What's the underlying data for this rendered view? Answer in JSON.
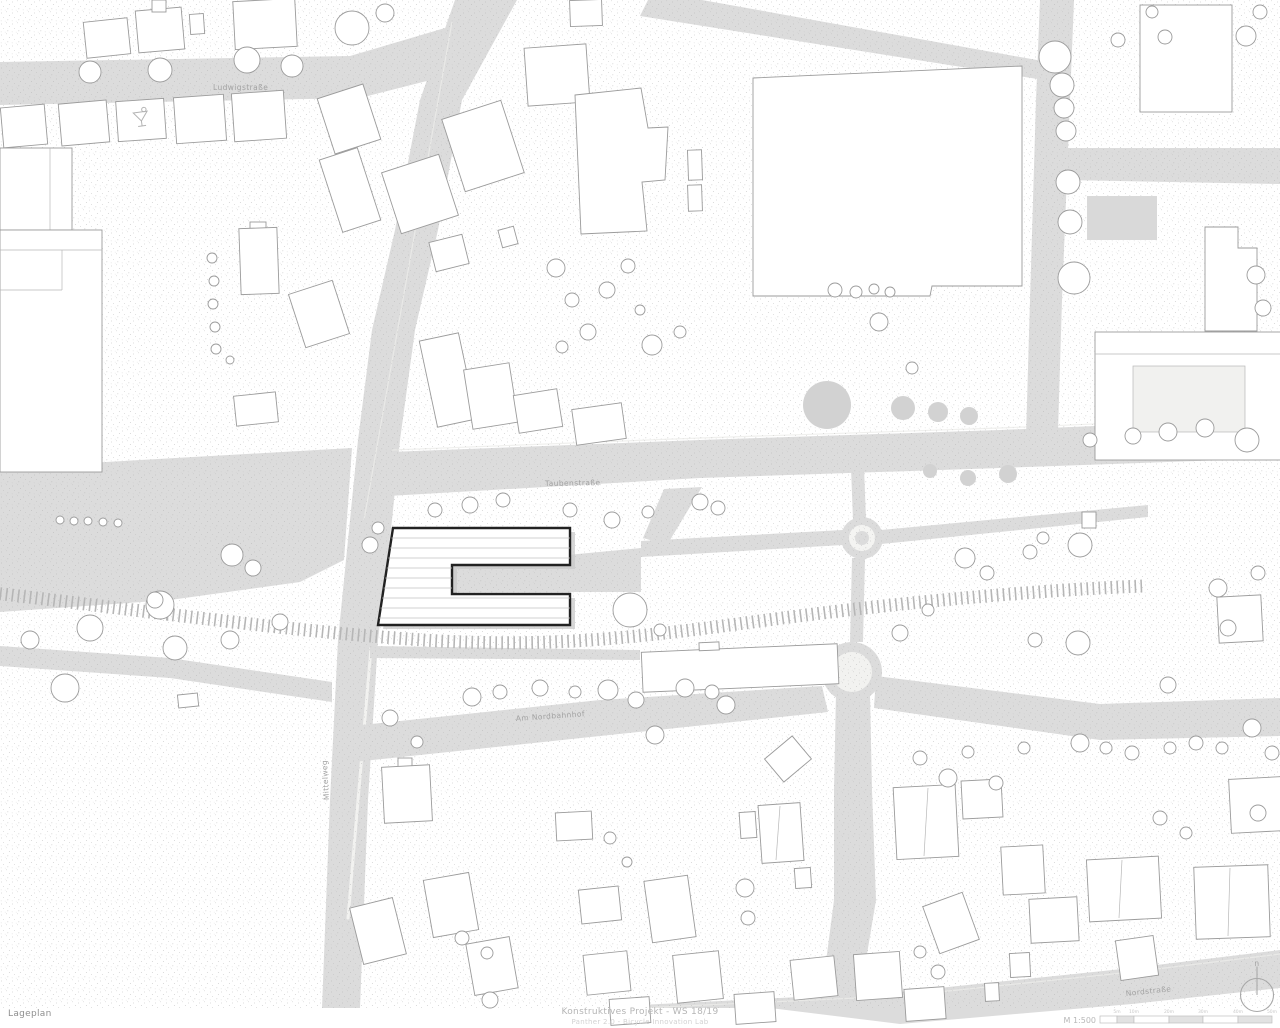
{
  "plan": {
    "streets": {
      "ludwigstrasse": "Ludwigstraße",
      "taubenstrasse": "Taubenstraße",
      "am_nordbahnhof": "Am Nordbahnhof",
      "mittelweg": "Mittelweg",
      "nordstrasse": "Nordstraße"
    },
    "north_marker": "n"
  },
  "title_block": {
    "plan_label": "Lageplan",
    "project_title": "Konstruktives Projekt - WS 18/19",
    "project_subtitle": "Panther 2.0 - Bicycle Innovation Lab",
    "scale_label": "M 1:500",
    "scale_ticks": [
      "5m",
      "10m",
      "20m",
      "30m",
      "40m",
      "50m"
    ]
  },
  "colors": {
    "road": "#dcdcdc",
    "building_outline": "#9b9b9b",
    "building_fill": "#ffffff",
    "project_outline": "#222222",
    "rail": "#b6b6b6",
    "label_text": "#a2a2a2"
  }
}
